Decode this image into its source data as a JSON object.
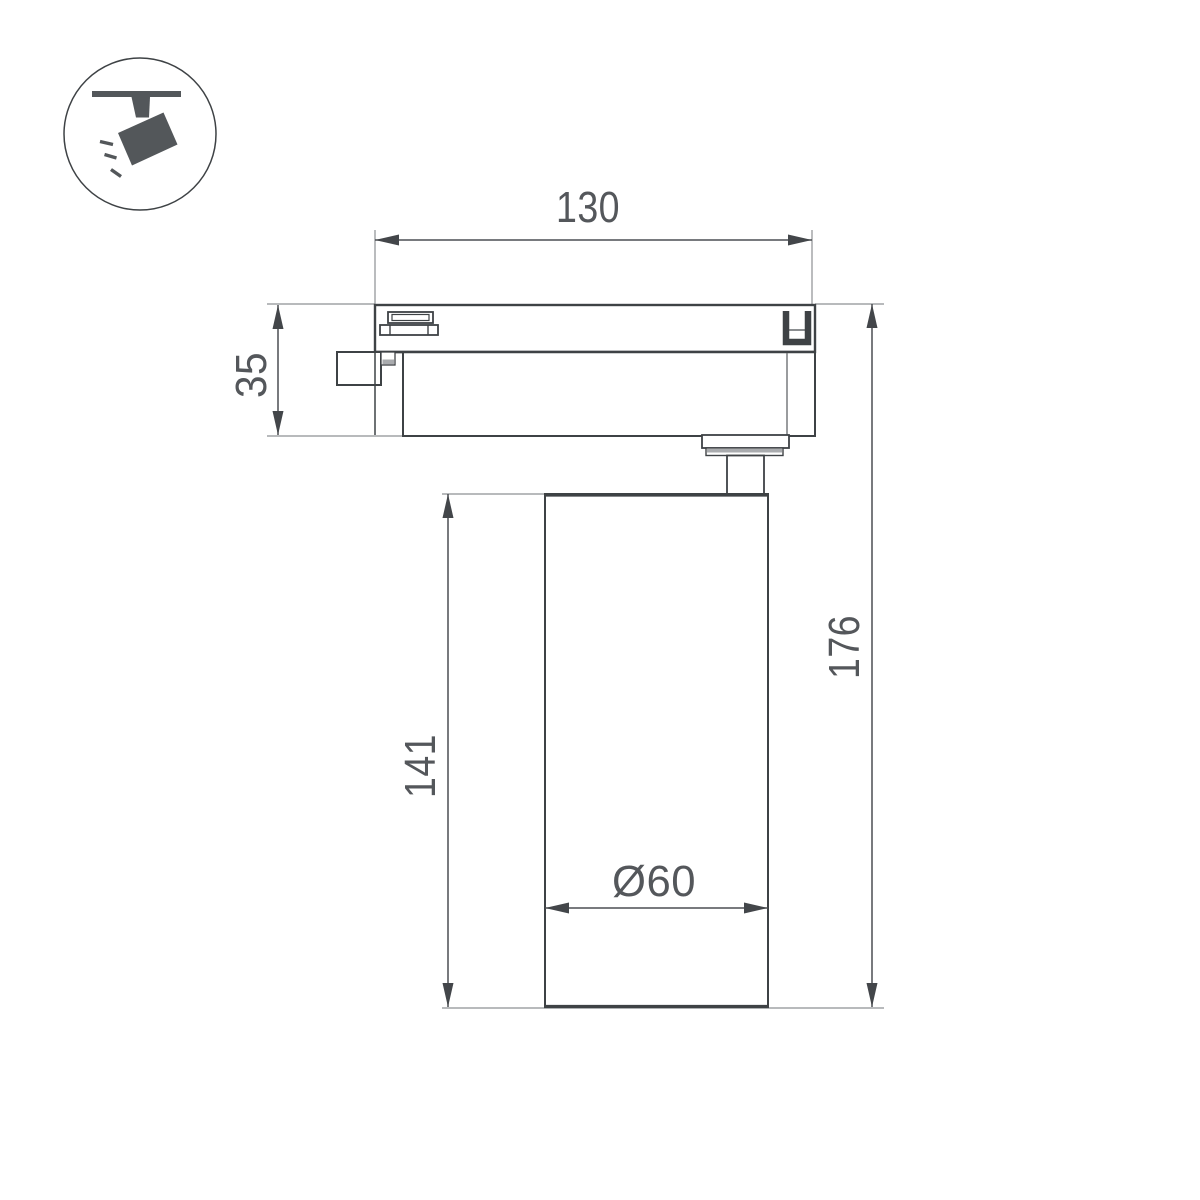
{
  "icon": {
    "name": "ceiling-track-spotlight-pictogram"
  },
  "dimensions": {
    "width_mm": "130",
    "head_height_mm": "35",
    "body_height_mm": "141",
    "total_height_mm": "176",
    "diameter_mm": "Ø60"
  },
  "colors": {
    "line": "#3e4245",
    "dim_line": "#4c4f53",
    "ext_line": "#8d9093",
    "arrow": "#43464a",
    "text": "#54575b",
    "icon": "#53575a",
    "shade": "#a9abae",
    "background": "#ffffff"
  }
}
